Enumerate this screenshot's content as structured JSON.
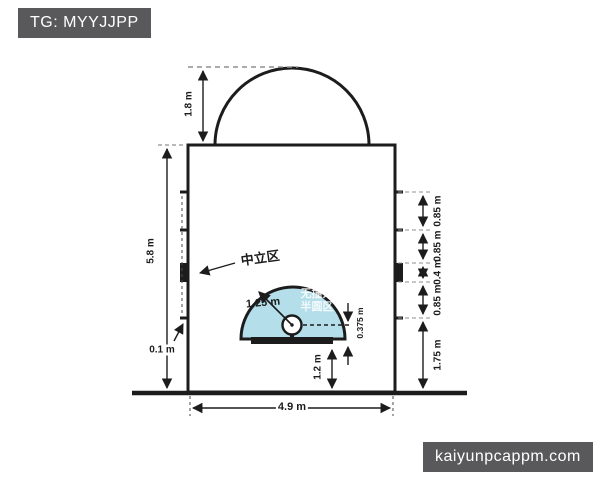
{
  "watermarks": {
    "top": "TG: MYYJJPP",
    "bottom": "kaiyunpcappm.com"
  },
  "diagram": {
    "subject": "basketball restricted area (key) dimension diagram",
    "dimensions": {
      "free_throw_arc_radius": "1.8 m",
      "lane_length": "5.8 m",
      "hash_mark_depth": "0.1 m",
      "lane_width": "4.9 m",
      "no_charge_radius": "1.25 m",
      "rim_to_backboard": "0.375 m",
      "backboard_to_endline": "1.2 m",
      "right_segments": [
        "0.85 m",
        "0.85 m",
        "0.4 m",
        "0.85 m",
        "1.75 m"
      ]
    },
    "labels": {
      "neutral_zone": "中立区",
      "no_charge_line1": "无撞人",
      "no_charge_line2": "半圆区"
    },
    "colors": {
      "line": "#1c1c1c",
      "semicircle_fill": "#b4dfea",
      "badge_bg": "#59595b",
      "badge_text": "#ffffff",
      "dash_gray": "#8f8f8f"
    }
  }
}
